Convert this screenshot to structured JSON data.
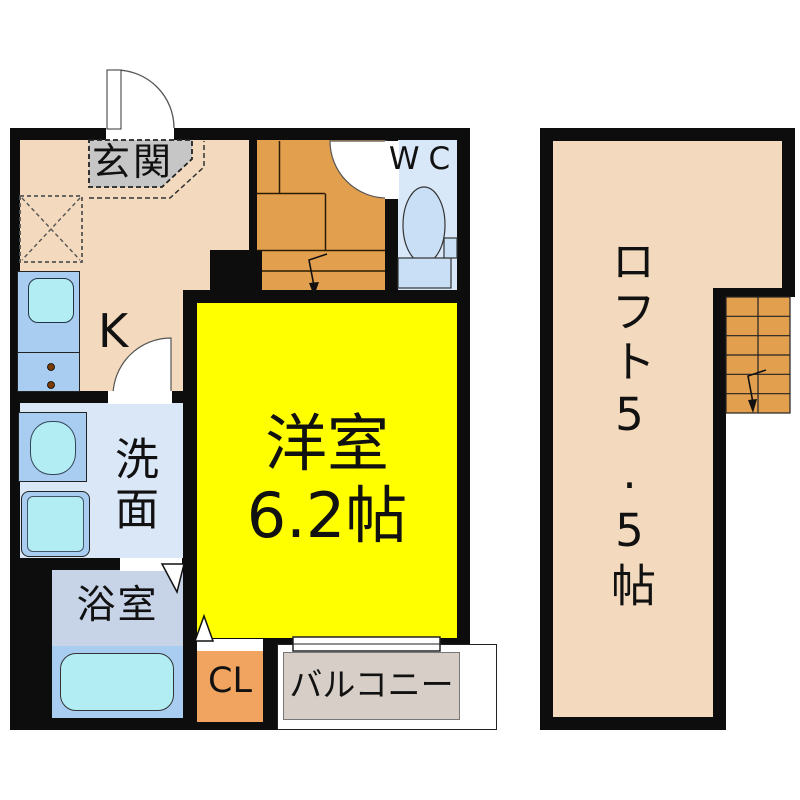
{
  "floor1": {
    "entrance": "玄関",
    "kitchen": "K",
    "wc": "WC",
    "washroom": "洗面",
    "bathroom": "浴室",
    "main_room_name": "洋室",
    "main_room_area": "6.2帖",
    "closet": "CL",
    "balcony": "バルコニー"
  },
  "loft": {
    "label": "ロフト5.5帖"
  },
  "colors": {
    "wall": "#0d0d0d",
    "room_peach": "#F3D9BD",
    "accent_orange": "#F0A45F",
    "stairs_orange": "#E2A04F",
    "main_room_yellow": "#FFFF00",
    "entrance_gray": "#C6C6C6",
    "fixture_blue": "#A9CDF0",
    "fixture_cyan": "#B2EDF4",
    "washroom_blue": "#DAE7F7",
    "bathroom_blue": "#C7D4E7",
    "wc_blue": "#D9E8F9",
    "balcony_gray": "#D7CFC7"
  }
}
